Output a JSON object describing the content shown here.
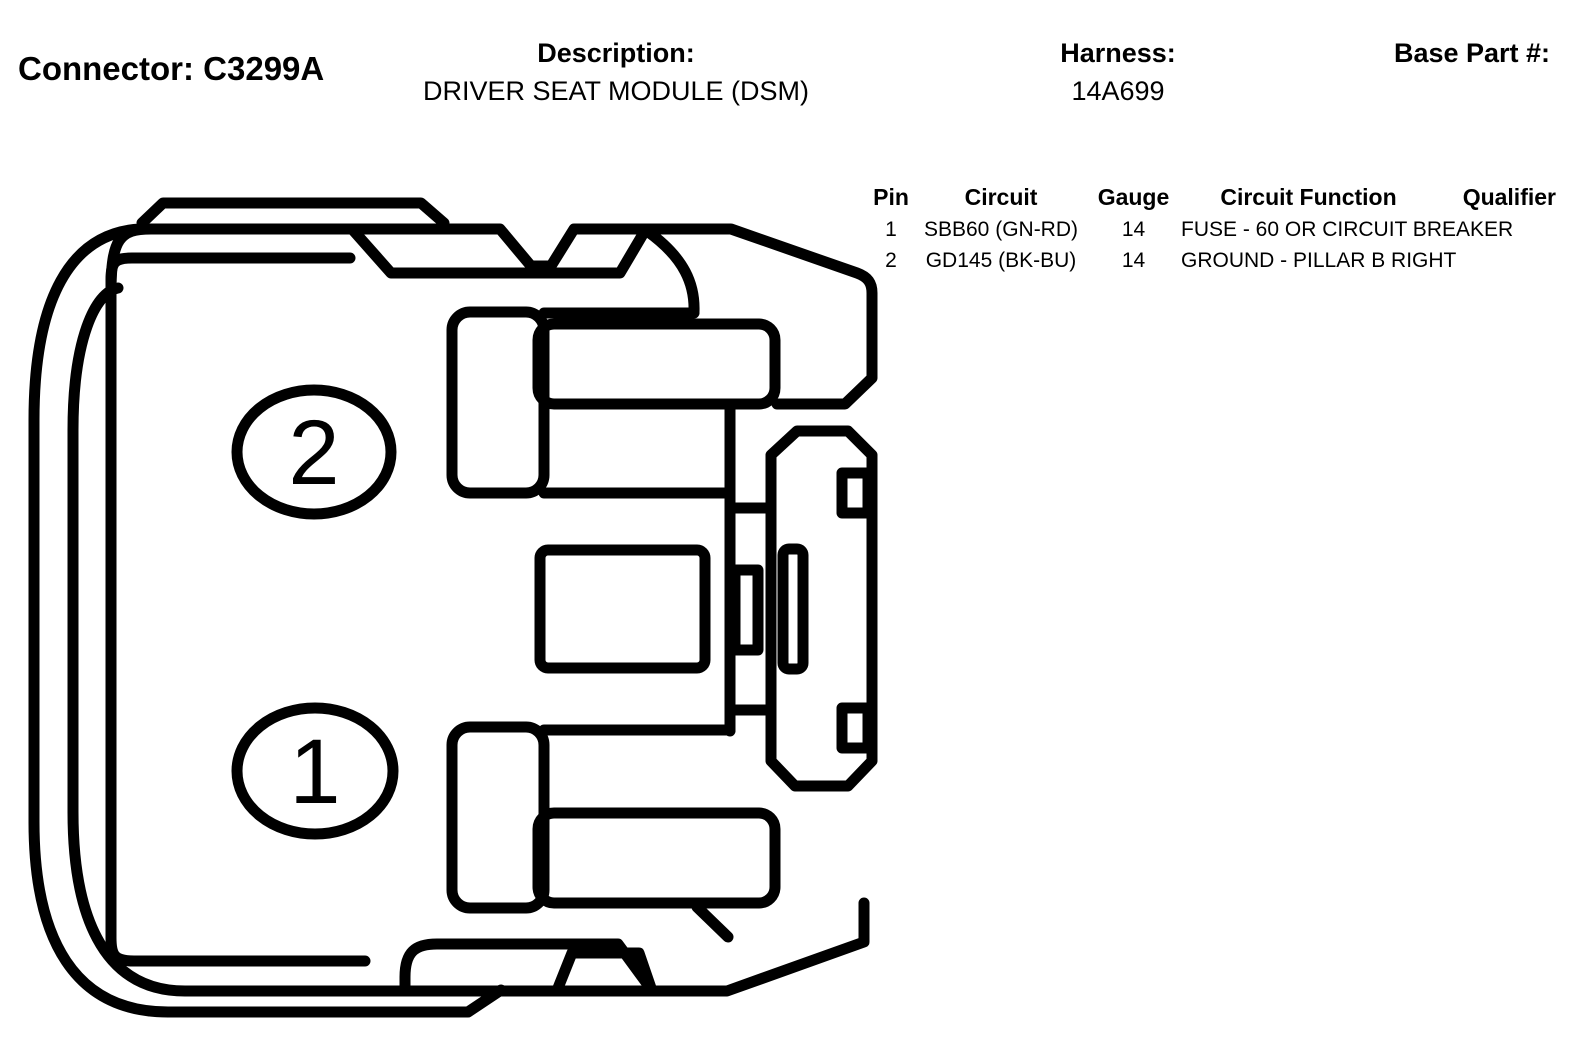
{
  "header": {
    "connector": "Connector: C3299A",
    "description_label": "Description:",
    "description_value": "DRIVER SEAT MODULE (DSM)",
    "harness_label": "Harness:",
    "harness_value": "14A699",
    "base_part_label": "Base Part #:",
    "base_part_value": ""
  },
  "pin_table": {
    "columns": [
      "Pin",
      "Circuit",
      "Gauge",
      "Circuit Function",
      "Qualifier"
    ],
    "rows": [
      {
        "pin": "1",
        "circuit": "SBB60 (GN-RD)",
        "gauge": "14",
        "circuit_function": "FUSE - 60 OR CIRCUIT BREAKER",
        "qualifier": ""
      },
      {
        "pin": "2",
        "circuit": "GD145 (BK-BU)",
        "gauge": "14",
        "circuit_function": "GROUND - PILLAR B RIGHT",
        "qualifier": ""
      }
    ]
  },
  "diagram": {
    "type": "connector-face-view",
    "cavity_labels": [
      "2",
      "1"
    ],
    "line_color": "#000000",
    "background": "#ffffff"
  }
}
